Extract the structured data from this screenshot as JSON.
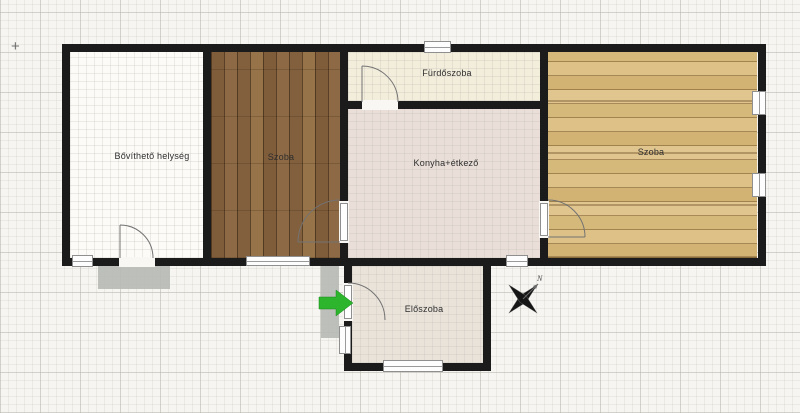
{
  "app": {
    "origin_marker": "+"
  },
  "plan": {
    "wall_color": "#1b1b1b",
    "step_color": "#b7bab6",
    "entrance_arrow_color": "#2db52d",
    "rooms": [
      {
        "label": "Bővíthető helység",
        "floor_type": "empty-white",
        "floor_color": "#fcfbf8"
      },
      {
        "label": "Szoba",
        "floor_type": "dark-wood-planks",
        "floor_color": "#876241"
      },
      {
        "label": "Fürdőszoba",
        "floor_type": "tile",
        "floor_color": "#f3eddb"
      },
      {
        "label": "Konyha+étkező",
        "floor_type": "tile",
        "floor_color": "#e9dfd8"
      },
      {
        "label": "Szoba",
        "floor_type": "light-wood-planks",
        "floor_color": "#d9bc7f"
      },
      {
        "label": "Előszoba",
        "floor_type": "tile",
        "floor_color": "#eae3da"
      }
    ],
    "compass": {
      "north_label": "N"
    }
  }
}
